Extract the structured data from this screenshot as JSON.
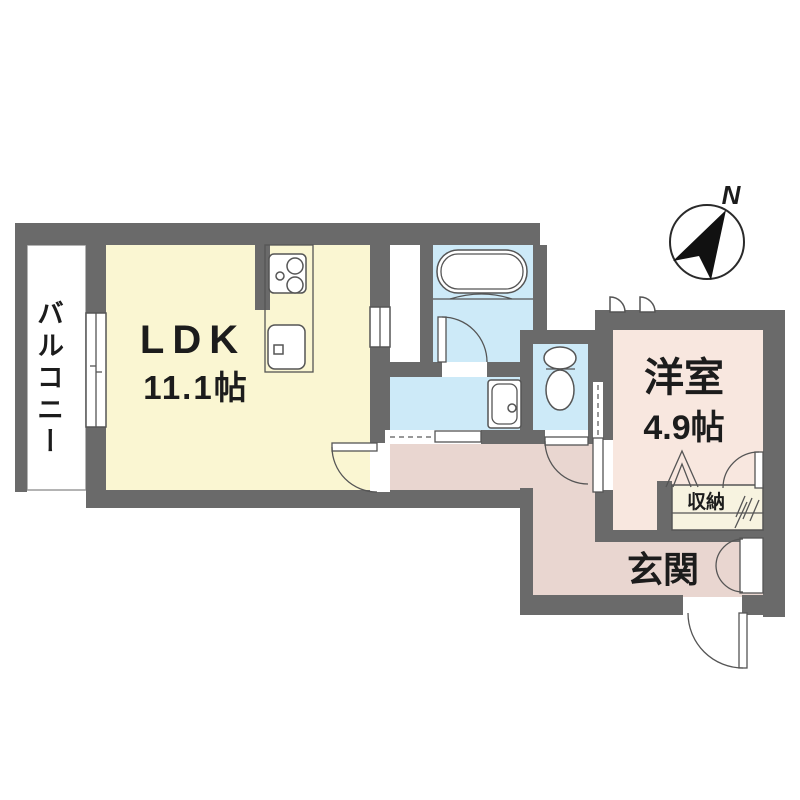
{
  "plan": {
    "compass": {
      "north_label": "N"
    },
    "rooms": {
      "balcony": {
        "label": "バルコニー"
      },
      "ldk": {
        "label": "LDK",
        "size": "11.1帖"
      },
      "bedroom": {
        "label": "洋室",
        "size": "4.9帖"
      },
      "storage": {
        "label": "収納"
      },
      "entrance": {
        "label": "玄関"
      }
    },
    "colors": {
      "wall": "#6a6a6a",
      "ldk": "#faf6d2",
      "bedroom": "#f8e7df",
      "corridor": "#e9d6d0",
      "wet": "#cdeaf8",
      "storage": "#f7f3e0",
      "line": "#555555",
      "text": "#1c1c1c"
    }
  }
}
